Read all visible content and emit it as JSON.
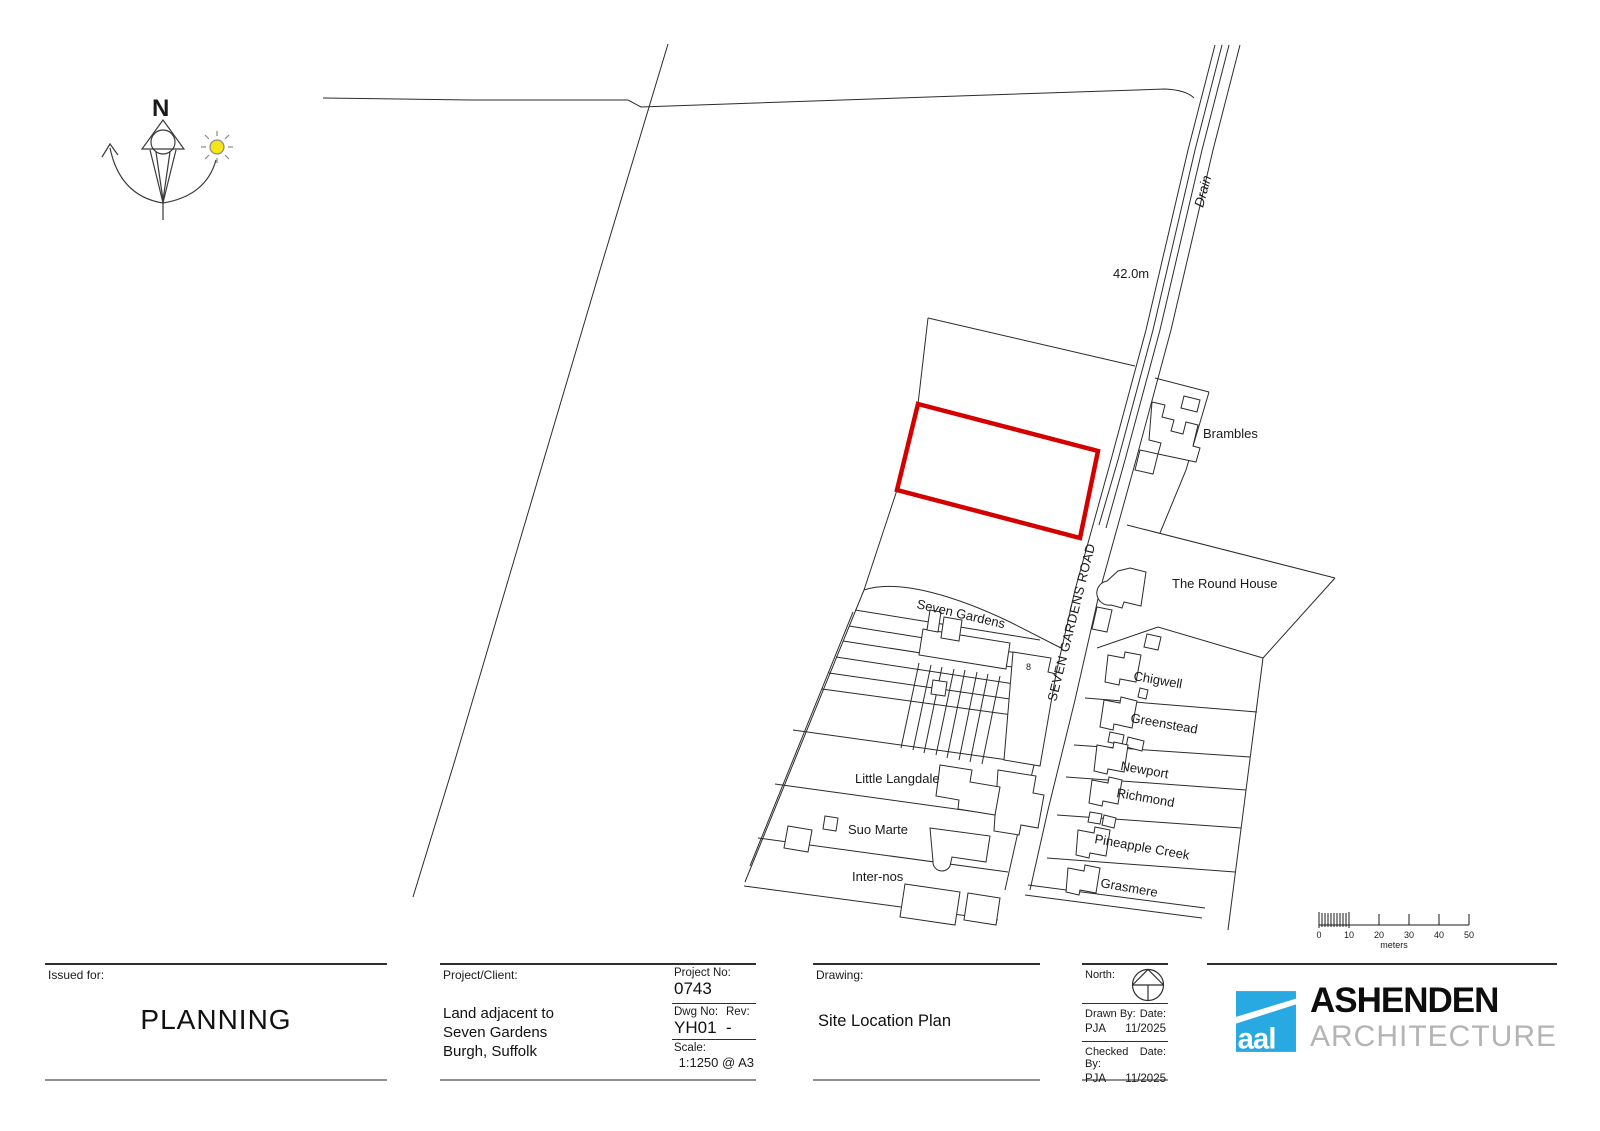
{
  "compass": {
    "north_letter": "N",
    "sun_color": "#f5e616"
  },
  "map": {
    "site_boundary_color": "#d40000",
    "labels": {
      "drain": "Drain",
      "spot_height": "42.0m",
      "brambles": "Brambles",
      "round_house": "The Round House",
      "seven_gardens": "Seven Gardens",
      "road": "SEVEN GARDENS ROAD",
      "plot_number": "8",
      "chigwell": "Chigwell",
      "greenstead": "Greenstead",
      "newport": "Newport",
      "richmond": "Richmond",
      "little_langdale": "Little Langdale",
      "pineapple_creek": "Pineapple Creek",
      "suo_marte": "Suo Marte",
      "grasmere": "Grasmere",
      "inter_nos": "Inter-nos"
    }
  },
  "scale_bar": {
    "tick_labels": [
      "0",
      "10",
      "20",
      "30",
      "40",
      "50"
    ],
    "unit_label": "meters"
  },
  "title_block": {
    "issued_for_label": "Issued for:",
    "issued_for_value": "PLANNING",
    "project_client_label": "Project/Client:",
    "client_line1": "Land adjacent to",
    "client_line2": "Seven Gardens",
    "client_line3": "Burgh, Suffolk",
    "project_no_label": "Project No:",
    "project_no_value": "0743",
    "dwg_no_label": "Dwg No:",
    "dwg_no_value": "YH01",
    "rev_label": "Rev:",
    "rev_value": "-",
    "scale_label": "Scale:",
    "scale_value": "1:1250 @ A3",
    "drawing_label": "Drawing:",
    "drawing_value": "Site Location Plan",
    "north_label": "North:",
    "drawn_by_label": "Drawn By:",
    "drawn_by_value": "PJA",
    "drawn_date_label": "Date:",
    "drawn_date_value": "11/2025",
    "checked_by_label": "Checked By:",
    "checked_by_value": "PJA",
    "checked_date_label": "Date:",
    "checked_date_value": "11/2025"
  },
  "logo": {
    "brand_color": "#29a9e1",
    "mark_text": "aal",
    "name_line1": "ASHENDEN",
    "name_line2": "ARCHITECTURE"
  }
}
